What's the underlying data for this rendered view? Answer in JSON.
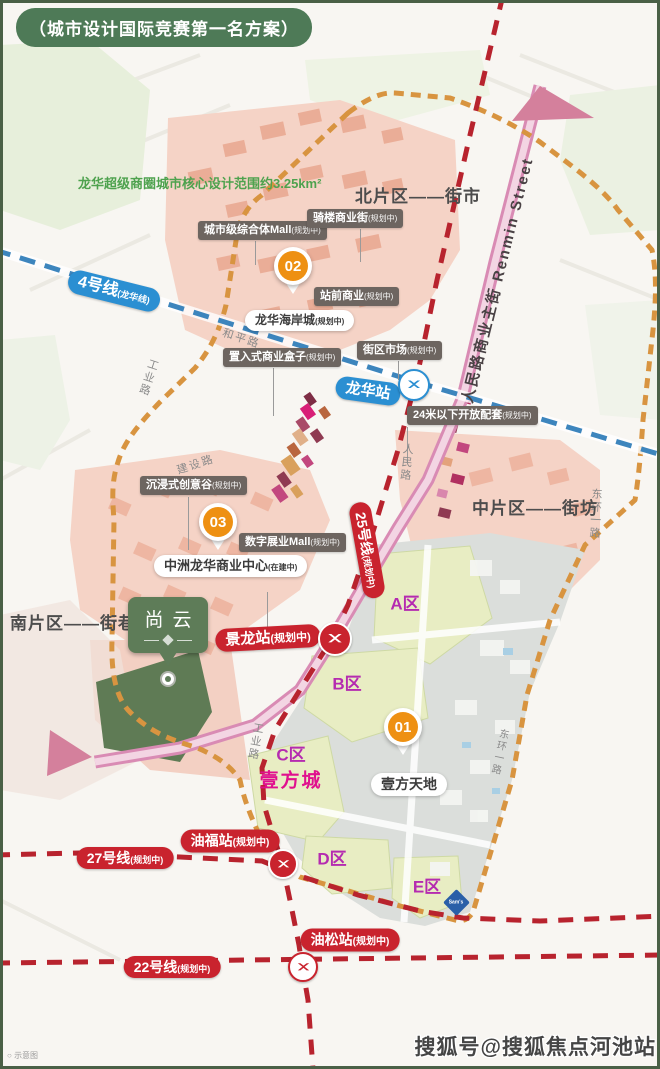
{
  "badge": {
    "label": "（城市设计国际竞赛第一名方案）"
  },
  "scope_note": {
    "label": "龙华超级商圈城市核心设计范围约3.25km²"
  },
  "districts": [
    {
      "label": "北片区——街市"
    },
    {
      "label": "中片区——街坊"
    },
    {
      "label": "南片区——街巷"
    }
  ],
  "poi": [
    {
      "label": "城市级综合体Mall",
      "suffix": "(规划中)"
    },
    {
      "label": "骑楼商业街",
      "suffix": "(规划中)"
    },
    {
      "label": "站前商业",
      "suffix": "(规划中)"
    },
    {
      "label": "街区市场",
      "suffix": "(规划中)"
    },
    {
      "label": "置入式商业盒子",
      "suffix": "(规划中)"
    },
    {
      "label": "24米以下开放配套",
      "suffix": "(规划中)"
    },
    {
      "label": "沉浸式创意谷",
      "suffix": "(规划中)"
    },
    {
      "label": "数字展业Mall",
      "suffix": "(规划中)"
    }
  ],
  "white_labels": [
    {
      "label": "龙华海岸城",
      "suffix": "(规划中)"
    },
    {
      "label": "中洲龙华商业中心",
      "suffix": "(在建中)"
    },
    {
      "label": "壹方天地",
      "suffix": ""
    }
  ],
  "pins": [
    {
      "number": "01"
    },
    {
      "number": "02"
    },
    {
      "number": "03"
    }
  ],
  "zones": [
    {
      "label": "A区"
    },
    {
      "label": "B区"
    },
    {
      "label": "C区"
    },
    {
      "label": "D区"
    },
    {
      "label": "E区"
    }
  ],
  "estate": {
    "name": "壹方城"
  },
  "metro_lines": [
    {
      "label": "4号线",
      "suffix": "(龙华线)",
      "color": "#2b8fd2"
    },
    {
      "label": "25号线",
      "suffix": "(规划中)",
      "color": "#c9232e"
    },
    {
      "label": "27号线",
      "suffix": "(规划中)",
      "color": "#c9232e"
    },
    {
      "label": "22号线",
      "suffix": "(规划中)",
      "color": "#c9232e"
    }
  ],
  "stations": [
    {
      "label": "龙华站",
      "suffix": ""
    },
    {
      "label": "景龙站",
      "suffix": "(规划中)"
    },
    {
      "label": "油福站",
      "suffix": "(规划中)"
    },
    {
      "label": "油松站",
      "suffix": "(规划中)"
    }
  ],
  "roads": [
    {
      "label": "和平路"
    },
    {
      "label": "工业路"
    },
    {
      "label": "建设路"
    },
    {
      "label": "人民路"
    },
    {
      "label": "东环一路"
    },
    {
      "label": "东环一路"
    },
    {
      "label": "工业路"
    }
  ],
  "main_street": {
    "label": "人民路商业主街 Renmin Street"
  },
  "shangyun": {
    "name": "尚云"
  },
  "sams": {
    "label": "Sam's"
  },
  "watermark": {
    "label": "搜狐号@搜狐焦点河池站"
  },
  "footnote": {
    "label": "示意图"
  },
  "colors": {
    "badge_green": "#4e7a57",
    "note_green": "#4ea24e",
    "metro_blue": "#2b8fd2",
    "metro_red": "#c9232e",
    "boundary_orange": "#d89440",
    "pin_orange": "#ee9012",
    "zone_magenta": "#b52bb0",
    "estate_pink": "#e0108e",
    "shangyun_green": "#5e7c58",
    "sams_blue": "#2a5fa8"
  }
}
